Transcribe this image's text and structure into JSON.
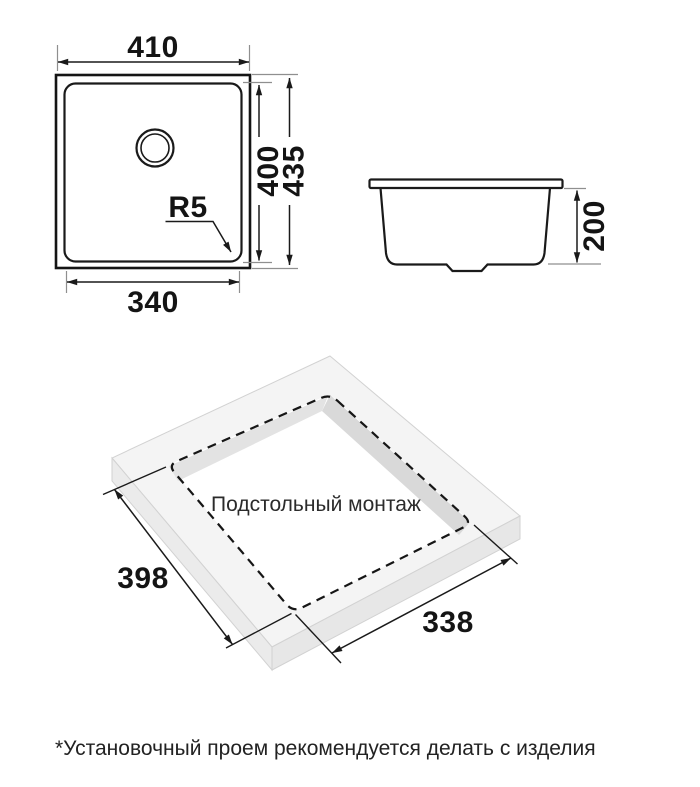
{
  "figure": {
    "top_view": {
      "overall_width": "410",
      "bowl_depth": "400",
      "overall_depth": "435",
      "corner_radius": "R5",
      "bowl_width": "340"
    },
    "side_view": {
      "bowl_height": "200"
    },
    "installation_view": {
      "caption": "Подстольный монтаж",
      "cutout_length": "398",
      "cutout_width": "338"
    },
    "footnote": "*Установочный проем рекомендуется делать с изделия"
  },
  "colors": {
    "line": "#1a1a1a",
    "extension_line": "#8f8f8f",
    "slab_top": "#f4f4f4",
    "slab_left_face": "#ebebeb",
    "slab_right_face": "#e7e7e7",
    "cutout_wall_dark": "#d9d9d9",
    "cutout_wall_light": "#e3e3e3",
    "background": "#ffffff"
  }
}
